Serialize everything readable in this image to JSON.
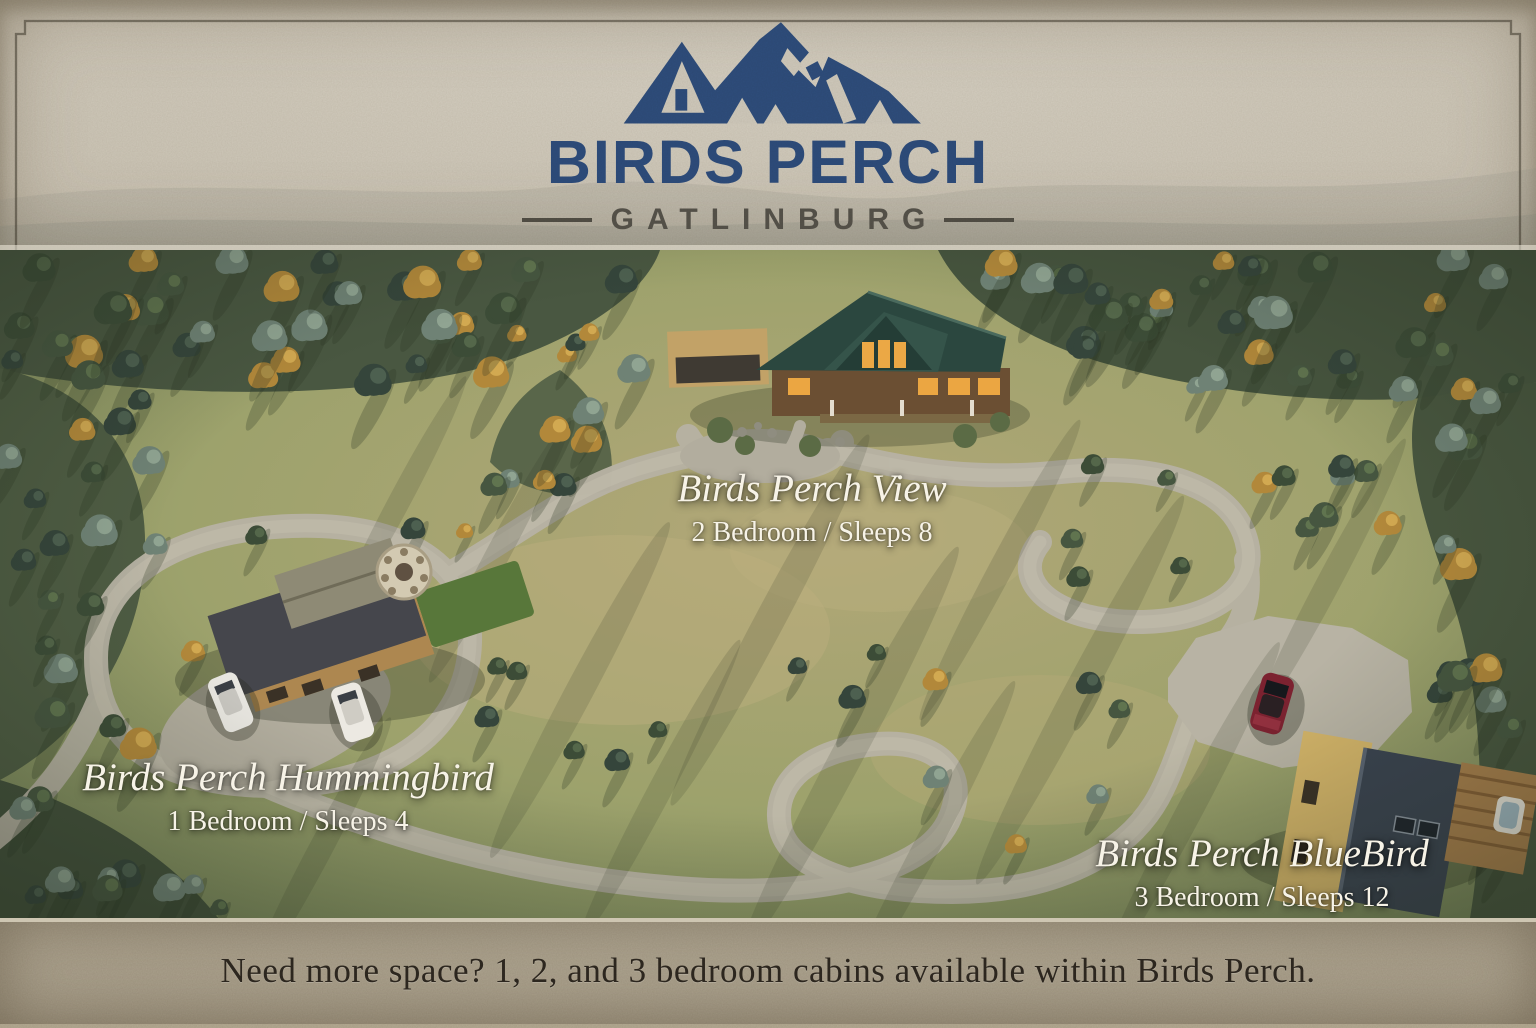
{
  "logo": {
    "icon": "mountain-icon",
    "brand": "BIRDS PERCH",
    "location": "GATLINBURG",
    "brand_color": "#2d4c7c",
    "location_color": "#55524a"
  },
  "map": {
    "type": "aerial-property-site-render",
    "cabins": [
      {
        "name": "Birds Perch View",
        "details": "2 Bedroom / Sleeps 8"
      },
      {
        "name": "Birds Perch Hummingbird",
        "details": "1 Bedroom / Sleeps 4"
      },
      {
        "name": "Birds Perch BlueBird",
        "details": "3 Bedroom / Sleeps 12"
      }
    ]
  },
  "footer": {
    "message": "Need more space? 1, 2, and 3 bedroom cabins available within Birds Perch."
  }
}
